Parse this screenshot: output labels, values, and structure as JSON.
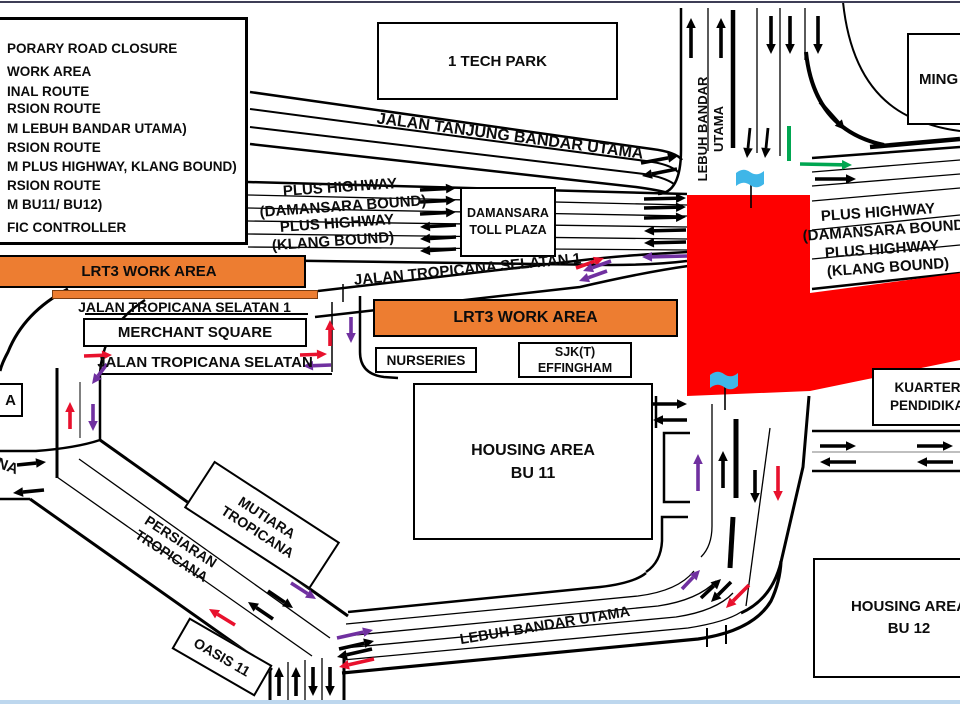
{
  "colors": {
    "black": "#000000",
    "purple": "#7030A0",
    "red": "#E8112D",
    "green": "#00A651",
    "closure": "#FE0000",
    "work-area": "#ED7D31",
    "flag": "#3FB6E8",
    "border-top": "#3E3E56",
    "border-bottom": "#BDD7EE"
  },
  "legend": {
    "lines": [
      "PORARY ROAD CLOSURE",
      "WORK AREA",
      "INAL ROUTE",
      "RSION ROUTE",
      "M LEBUH BANDAR UTAMA)",
      "RSION ROUTE",
      "M PLUS HIGHWAY, KLANG BOUND)",
      "RSION ROUTE",
      "M BU11/ BU12)",
      "FIC CONTROLLER"
    ]
  },
  "work_area_label": "LRT3 WORK AREA",
  "boxes": {
    "tech_park": "1 TECH PARK",
    "ming": "MING",
    "toll_plaza": [
      "DAMANSARA",
      "TOLL PLAZA"
    ],
    "merchant_square": "MERCHANT SQUARE",
    "nurseries": "NURSERIES",
    "sjkt": [
      "SJK(T)",
      "EFFINGHAM"
    ],
    "housing_bu11": [
      "HOUSING AREA",
      "BU 11"
    ],
    "kuarters": [
      "KUARTERS",
      "PENDIDIKAN"
    ],
    "housing_bu12": [
      "HOUSING AREA",
      "BU 12"
    ],
    "mutiara": [
      "MUTIARA",
      "TROPICANA"
    ],
    "oasis": "OASIS 11",
    "edge_box_a": "A"
  },
  "road_labels": {
    "jalan_tanjung": "JALAN TANJUNG BANDAR UTAMA",
    "plus_highway": "PLUS HIGHWAY",
    "damansara_bound": "(DAMANSARA BOUND)",
    "klang_bound": "(KLANG BOUND)",
    "jts1": "JALAN TROPICANA SELATAN 1",
    "jts": "JALAN TROPICANA SELATAN",
    "lebuh_bandar": [
      "LEBUH BANDAR",
      "UTAMA"
    ],
    "lebuh_bandar_utama": "LEBUH BANDAR UTAMA",
    "persiaran": [
      "PERSIARAN",
      "TROPICANA"
    ],
    "edge_na": "NA"
  },
  "arrows": [
    [
      691,
      58,
      691,
      18,
      "black"
    ],
    [
      721,
      58,
      721,
      18,
      "black"
    ],
    [
      771,
      16,
      771,
      54,
      "black"
    ],
    [
      790,
      16,
      790,
      54,
      "black"
    ],
    [
      818,
      16,
      818,
      54,
      "black"
    ],
    [
      820,
      102,
      845,
      130,
      "black"
    ],
    [
      750,
      128,
      747,
      158,
      "black",
      2.8
    ],
    [
      768,
      128,
      765,
      158,
      "black",
      2.8
    ],
    [
      800,
      164,
      852,
      165,
      "green"
    ],
    [
      815,
      179,
      856,
      179,
      "black"
    ],
    [
      641,
      163,
      678,
      156,
      "black"
    ],
    [
      677,
      169,
      642,
      176,
      "black"
    ],
    [
      420,
      190,
      456,
      188,
      "black"
    ],
    [
      420,
      202,
      456,
      200,
      "black"
    ],
    [
      420,
      214,
      456,
      212,
      "black"
    ],
    [
      456,
      225,
      420,
      227,
      "black"
    ],
    [
      456,
      237,
      420,
      239,
      "black"
    ],
    [
      456,
      249,
      420,
      251,
      "black"
    ],
    [
      644,
      199,
      686,
      198,
      "black"
    ],
    [
      644,
      208,
      686,
      207,
      "black"
    ],
    [
      644,
      218,
      686,
      217,
      "black"
    ],
    [
      686,
      230,
      644,
      231,
      "black"
    ],
    [
      686,
      242,
      644,
      243,
      "black"
    ],
    [
      687,
      256,
      642,
      257,
      "purple"
    ],
    [
      576,
      268,
      604,
      258,
      "red"
    ],
    [
      611,
      261,
      583,
      271,
      "purple"
    ],
    [
      607,
      271,
      579,
      281,
      "purple"
    ],
    [
      84,
      356,
      112,
      355,
      "red"
    ],
    [
      330,
      346,
      330,
      320,
      "red"
    ],
    [
      300,
      355,
      327,
      354,
      "red"
    ],
    [
      331,
      365,
      303,
      366,
      "purple"
    ],
    [
      107,
      364,
      92,
      384,
      "purple"
    ],
    [
      351,
      317,
      351,
      343,
      "purple"
    ],
    [
      70,
      429,
      70,
      402,
      "red"
    ],
    [
      93,
      404,
      93,
      431,
      "purple"
    ],
    [
      17,
      465,
      46,
      462,
      "black"
    ],
    [
      44,
      490,
      13,
      493,
      "black"
    ],
    [
      291,
      583,
      316,
      599,
      "purple"
    ],
    [
      268,
      591,
      293,
      608,
      "black"
    ],
    [
      273,
      619,
      248,
      602,
      "black"
    ],
    [
      235,
      625,
      209,
      609,
      "red"
    ],
    [
      279,
      696,
      279,
      667,
      "black"
    ],
    [
      296,
      696,
      296,
      667,
      "black"
    ],
    [
      313,
      667,
      313,
      696,
      "black"
    ],
    [
      330,
      667,
      330,
      696,
      "black"
    ],
    [
      337,
      638,
      373,
      630,
      "purple"
    ],
    [
      339,
      649,
      374,
      641,
      "black"
    ],
    [
      372,
      649,
      337,
      657,
      "black"
    ],
    [
      374,
      659,
      339,
      667,
      "red"
    ],
    [
      682,
      589,
      700,
      570,
      "purple"
    ],
    [
      701,
      598,
      721,
      579,
      "black"
    ],
    [
      731,
      582,
      711,
      602,
      "black"
    ],
    [
      749,
      585,
      726,
      608,
      "red"
    ],
    [
      698,
      491,
      698,
      454,
      "purple"
    ],
    [
      723,
      488,
      723,
      451,
      "black"
    ],
    [
      755,
      470,
      755,
      503,
      "black"
    ],
    [
      778,
      466,
      778,
      501,
      "red"
    ],
    [
      653,
      404,
      687,
      404,
      "black"
    ],
    [
      687,
      420,
      653,
      420,
      "black"
    ],
    [
      820,
      446,
      856,
      446,
      "black"
    ],
    [
      917,
      446,
      953,
      446,
      "black"
    ],
    [
      856,
      462,
      820,
      462,
      "black"
    ],
    [
      953,
      462,
      917,
      462,
      "black"
    ]
  ],
  "flags": [
    [
      736,
      170
    ],
    [
      710,
      372
    ]
  ]
}
